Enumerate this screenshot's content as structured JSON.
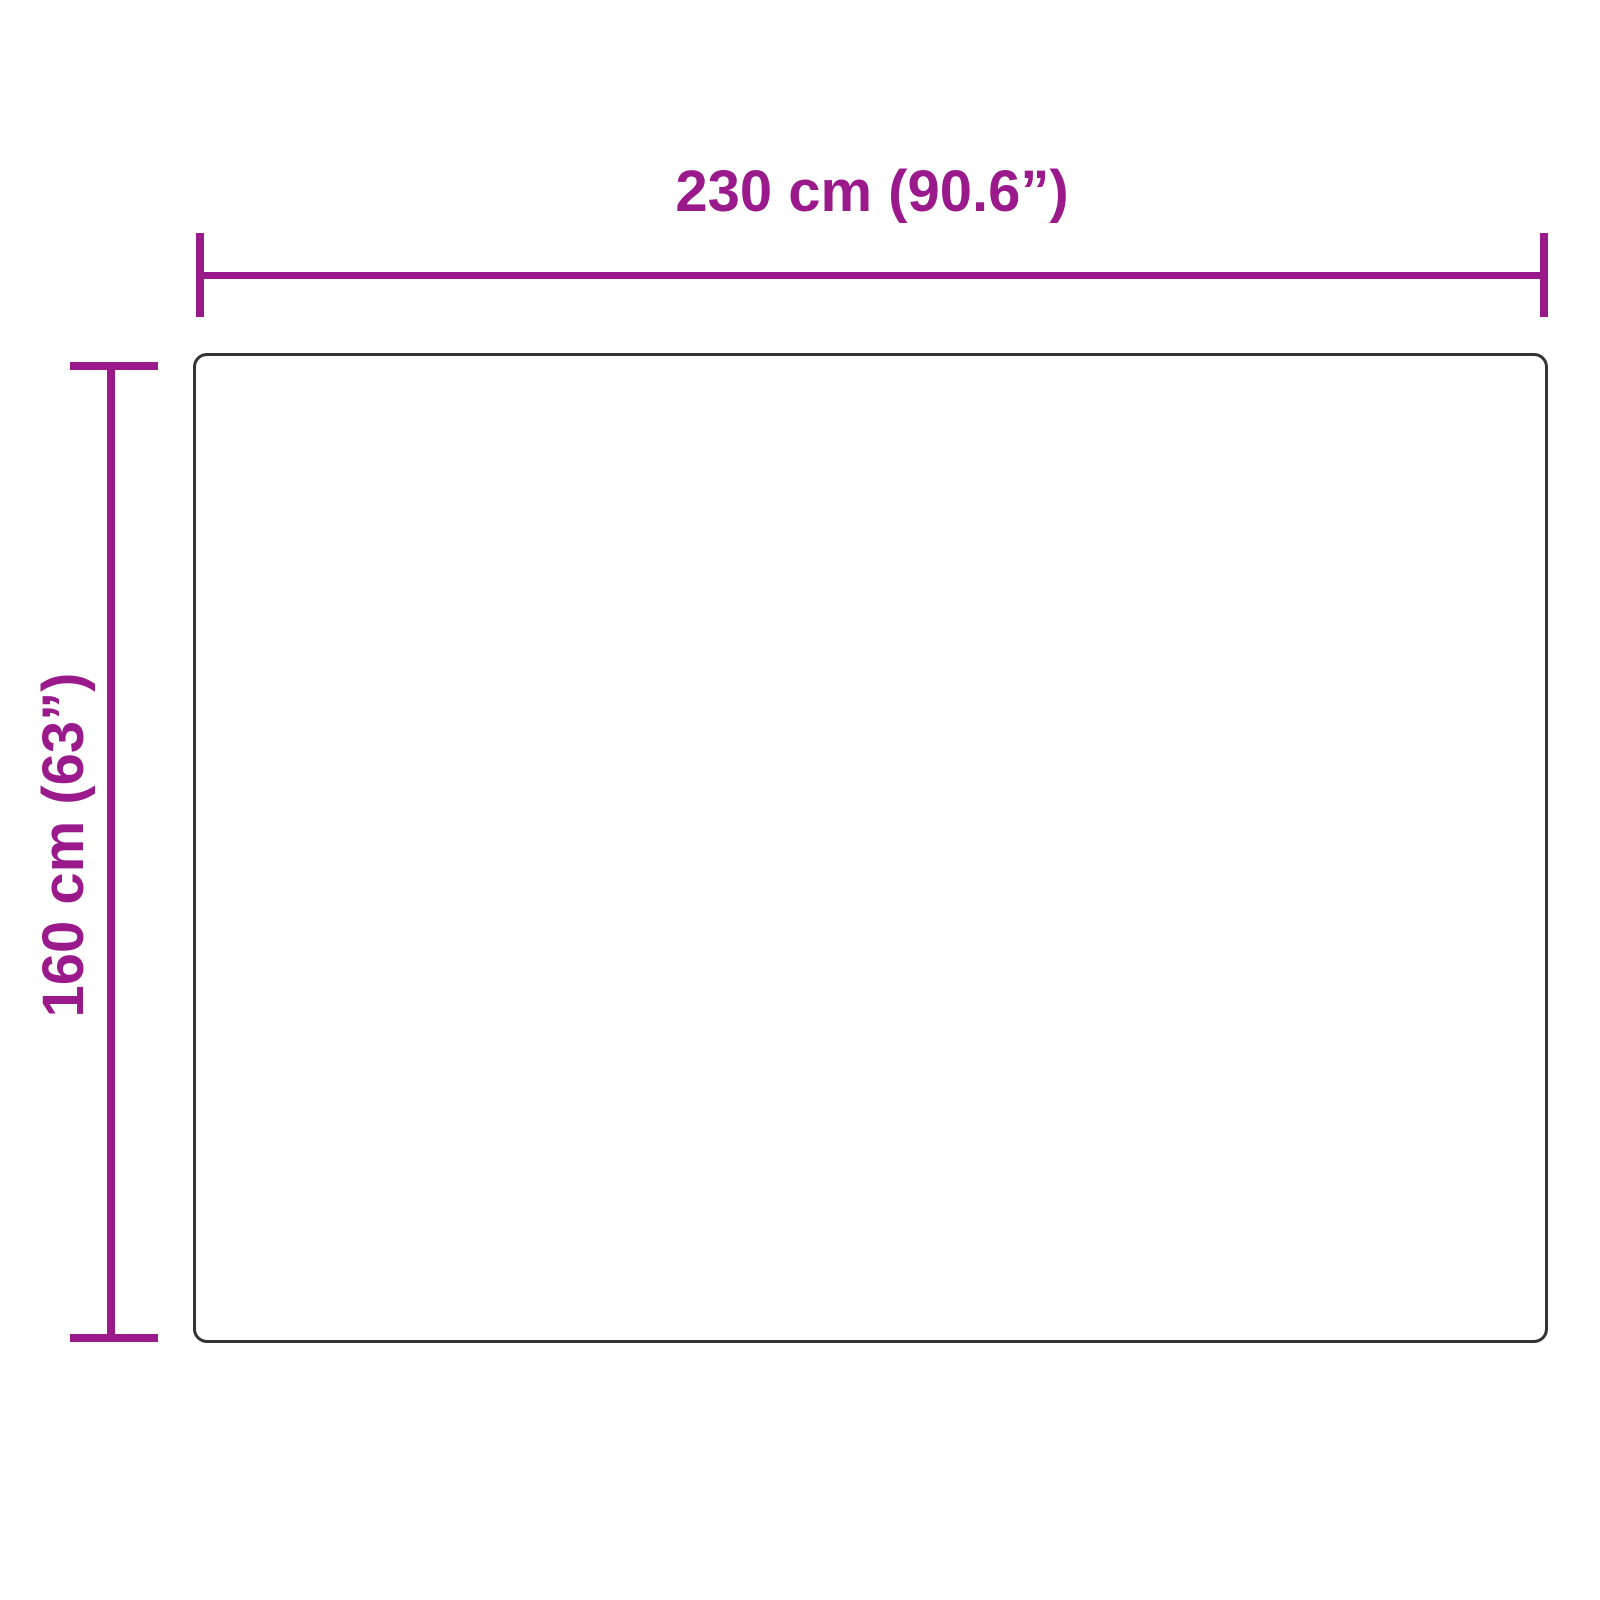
{
  "colors": {
    "accent": "#9a1a8c",
    "outline": "#333333",
    "background": "#ffffff"
  },
  "dimensions": {
    "width": {
      "label": "230 cm (90.6”)"
    },
    "height": {
      "label": "160 cm (63”)"
    }
  }
}
